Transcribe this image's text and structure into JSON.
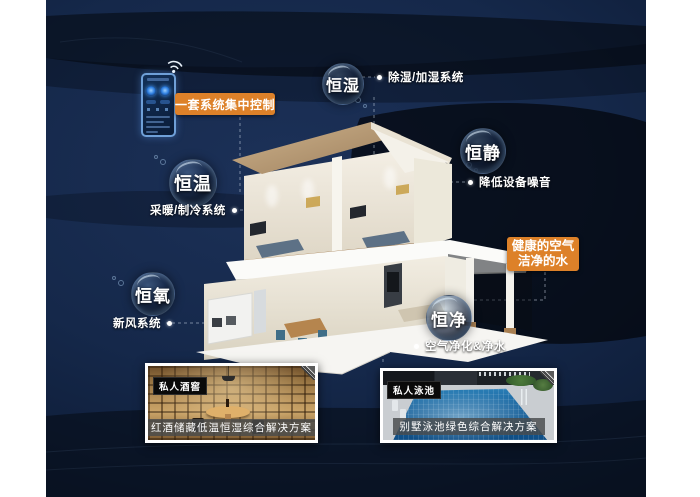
{
  "poster": {
    "theme": "smart-villa-comfort-systems",
    "colors": {
      "panel_navy": "#15284a",
      "wave_dark": "#04070d",
      "accent_orange": "#dd8129",
      "label_text": "#ffffff"
    }
  },
  "controller": {
    "box_label": "一套系统集中控制",
    "device": "wall-control-panel",
    "icon": "wifi-icon"
  },
  "bubbles": [
    {
      "name": "恒湿",
      "system": "除湿/加湿系统"
    },
    {
      "name": "恒静",
      "system": "降低设备噪音"
    },
    {
      "name": "恒温",
      "system": "采暖/制冷系统"
    },
    {
      "name": "恒氧",
      "system": "新风系统"
    },
    {
      "name": "恒净",
      "system": "空气净化&净水"
    }
  ],
  "highlight": {
    "line1": "健康的空气",
    "line2": "洁净的水"
  },
  "cards": [
    {
      "badge": "私人酒窖",
      "caption": "红酒储藏低温恒湿综合解决方案"
    },
    {
      "badge": "私人泳池",
      "caption": "别墅泳池绿色综合解决方案"
    }
  ]
}
